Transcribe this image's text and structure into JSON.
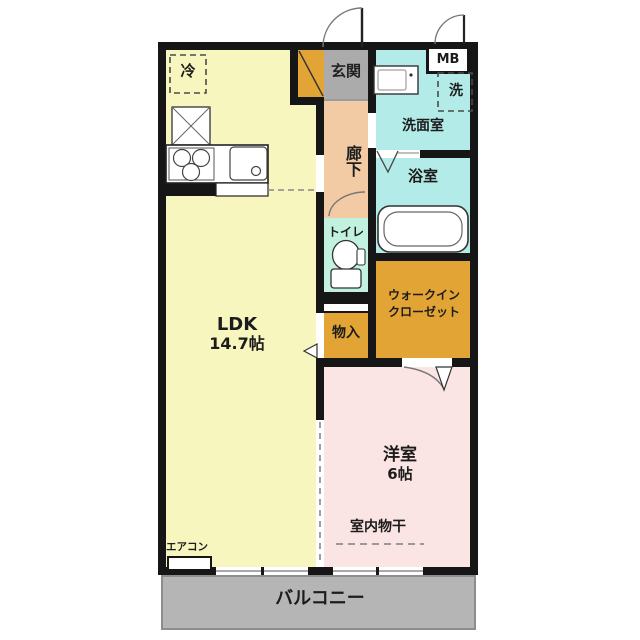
{
  "plan": {
    "type": "japanese-apartment-floor-plan",
    "rooms": {
      "ldk": {
        "name": "LDK",
        "size": "14.7帖"
      },
      "bedroom": {
        "name": "洋室",
        "size": "6帖"
      },
      "entrance": {
        "label": "玄関"
      },
      "hallway": {
        "label": "廊下"
      },
      "washroom": {
        "label": "洗面室"
      },
      "bathroom": {
        "label": "浴室"
      },
      "toilet": {
        "label": "トイレ"
      },
      "walk_in_closet": {
        "line1": "ウォークイン",
        "line2": "クローゼット"
      },
      "storage": {
        "label": "物入"
      },
      "balcony": {
        "label": "バルコニー"
      }
    },
    "fixtures": {
      "refrigerator": "冷",
      "washing_machine": "洗",
      "meter_box": "MB",
      "air_conditioner": "エアコン",
      "indoor_drying": "室内物干"
    },
    "colors": {
      "ldk_yellow": "#f8f6bf",
      "hallway_tan": "#f2cba4",
      "entrance_gray": "#ababab",
      "wet_area_cyan": "#b3ebe9",
      "toilet_mint": "#c3f1e0",
      "closet_orange": "#e2a434",
      "bedroom_pink": "#fae5e4",
      "balcony_gray": "#b5b5b5",
      "wall": "#161616"
    }
  }
}
